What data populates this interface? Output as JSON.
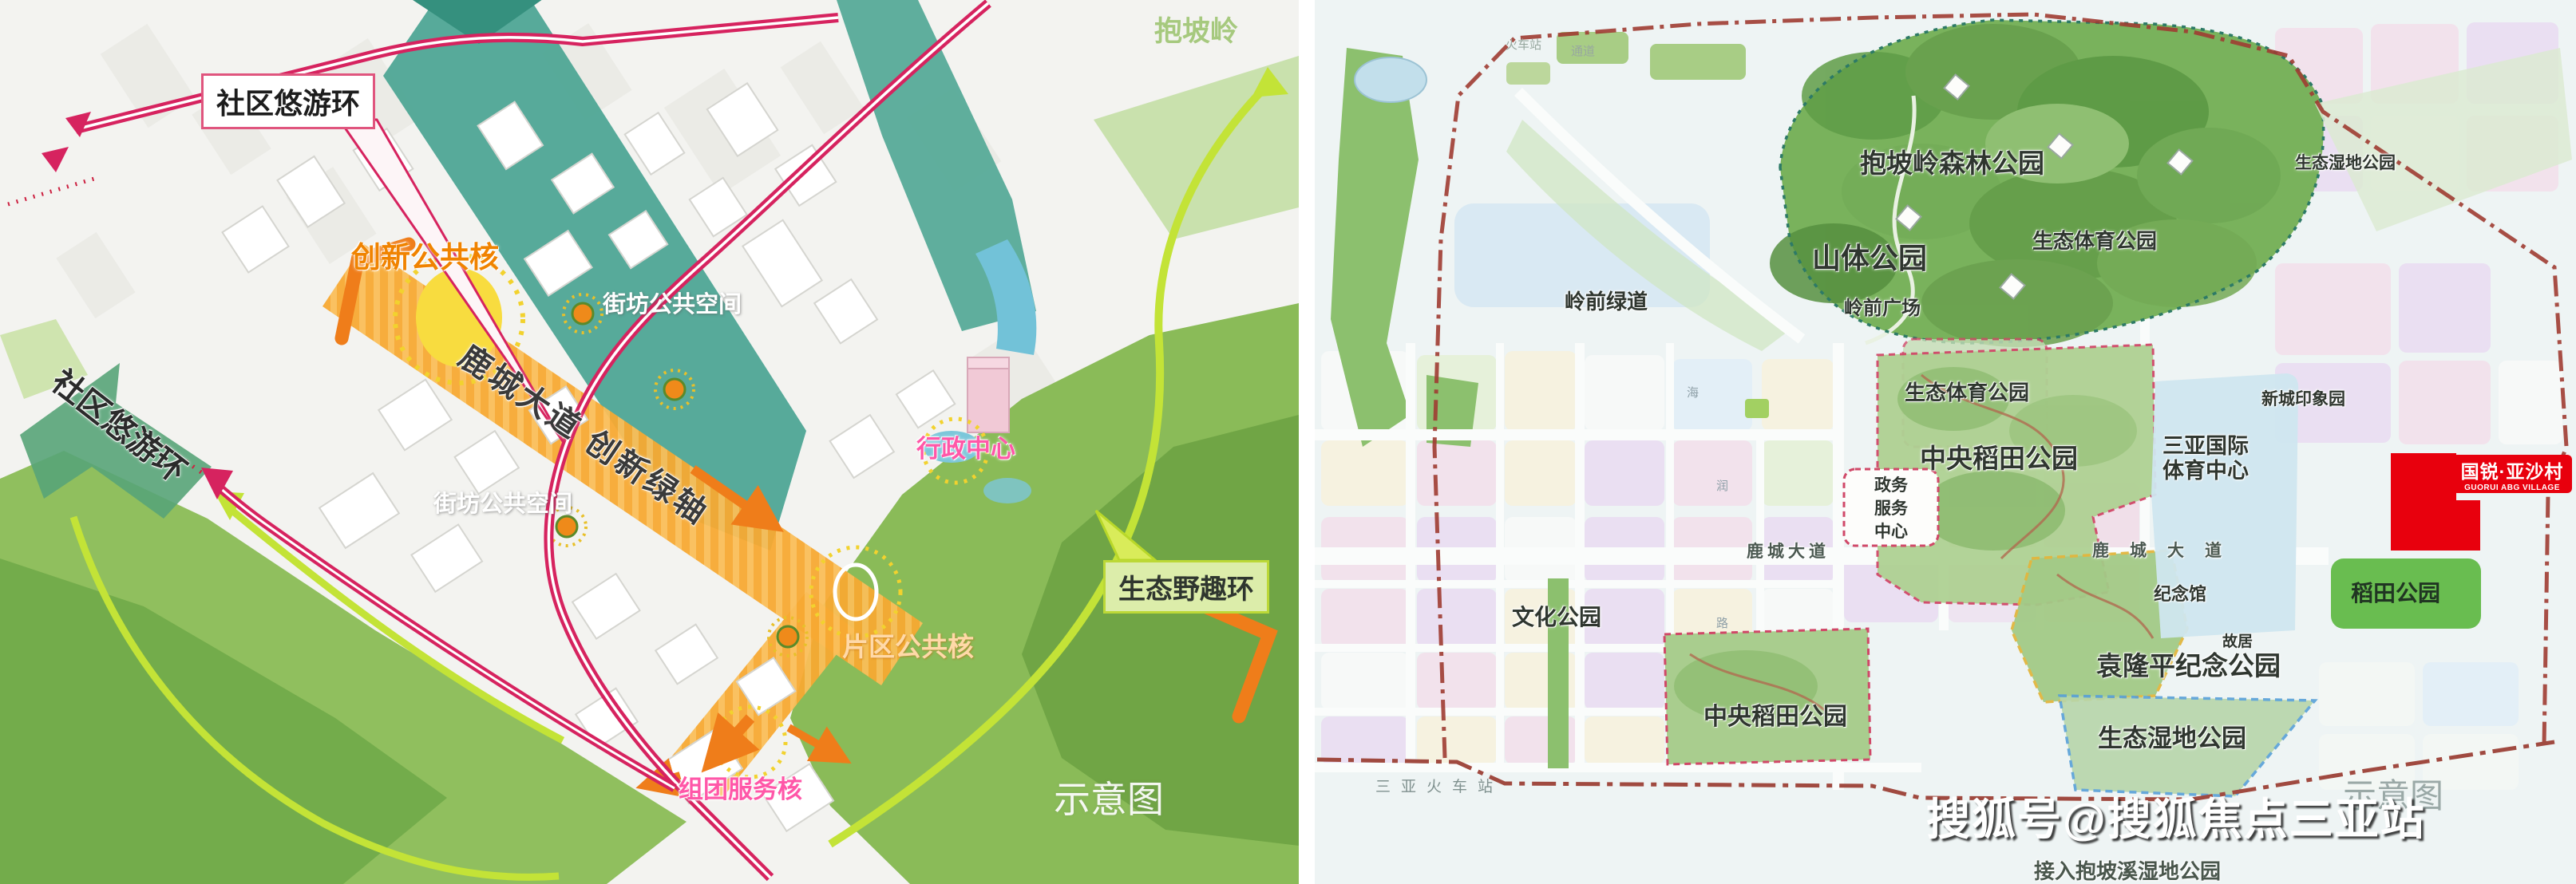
{
  "left": {
    "labels": {
      "community_loop_box": "社区悠游环",
      "community_loop_side": "社区悠游环",
      "innovation_core": "创新公共核",
      "block_public_space_a": "街坊公共空间",
      "block_public_space_b": "街坊公共空间",
      "main_axis": "鹿城大道 创新绿轴",
      "admin_center": "行政中心",
      "district_core": "片区公共核",
      "cluster_core": "组团服务核",
      "eco_wild_loop": "生态野趣环",
      "baopo_ridge": "抱坡岭",
      "schematic_watermark": "示意图"
    },
    "colors": {
      "loop_pink": "#d6235f",
      "eco_loop_green": "#c3e337",
      "axis_orange": "#f6a833",
      "corridor_teal": "#4aa492"
    }
  },
  "right": {
    "labels": {
      "forest_park": "抱坡岭森林公园",
      "mountain_park": "山体公园",
      "eco_sport_park_top": "生态体育公园",
      "lingqian_plaza": "岭前广场",
      "lingqian_greenway": "岭前绿道",
      "eco_wetland_right": "生态湿地公园",
      "new_town_garden": "新城印象园",
      "eco_sport_park_zone": "生态体育公园",
      "central_paddy_upper": "中央稻田公园",
      "intl_sport_line1": "三亚国际",
      "intl_sport_line2": "体育中心",
      "gov_line1": "政务",
      "gov_line2": "服务",
      "gov_line3": "中心",
      "lucheng_ave_left": "鹿城大道",
      "lucheng_ave_right": "鹿城大道",
      "culture_park": "文化公园",
      "memorial_hall": "纪念馆",
      "former_residence": "故居",
      "yuan_longping_park": "袁隆平纪念公园",
      "central_paddy_lower": "中央稻田公园",
      "eco_wetland_bottom": "生态湿地公园",
      "paddy_park": "稻田公园",
      "railway_station": "三亚火车站"
    },
    "notes": {
      "station_frag": "火车站",
      "passage_frag": "通道",
      "connect": "接入抱坡溪湿地公园",
      "road_chars": [
        "海",
        "润",
        "路"
      ]
    },
    "logo": {
      "cn": "国锐·亚沙村",
      "en": "GUORUI ABG VILLAGE",
      "color": "#e8000d"
    },
    "watermarks": {
      "sohu": "搜狐号@搜狐焦点三亚站",
      "schematic": "示意图"
    }
  }
}
